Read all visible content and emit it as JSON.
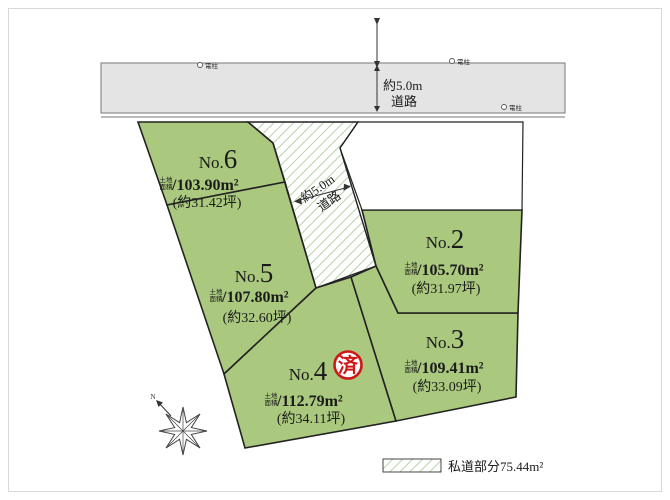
{
  "colors": {
    "lot_fill": "#aac87e",
    "lot_stroke": "#222222",
    "road_fill": "#e4e4e4",
    "hatch_line": "#a6c693",
    "stamp_red": "#cf1717",
    "text": "#1b1b1b"
  },
  "top_road": {
    "width_label": "約5.0m",
    "road_label": "道路"
  },
  "pole": {
    "label": "電柱"
  },
  "private_road": {
    "width_label": "約5.0m",
    "road_label": "道路"
  },
  "labels": {
    "slash": "/",
    "area_prefix_top": "土地",
    "area_prefix_bottom": "面積"
  },
  "lots": [
    {
      "id": "no6",
      "prefix": "No.",
      "number": "6",
      "area": "103.90m²",
      "tsubo": "(約31.42坪)"
    },
    {
      "id": "no5",
      "prefix": "No.",
      "number": "5",
      "area": "107.80m²",
      "tsubo": "(約32.60坪)"
    },
    {
      "id": "no2",
      "prefix": "No.",
      "number": "2",
      "area": "105.70m²",
      "tsubo": "(約31.97坪)"
    },
    {
      "id": "no3",
      "prefix": "No.",
      "number": "3",
      "area": "109.41m²",
      "tsubo": "(約33.09坪)"
    },
    {
      "id": "no4",
      "prefix": "No.",
      "number": "4",
      "area": "112.79m²",
      "tsubo": "(約34.11坪)"
    }
  ],
  "stamp": {
    "label": "済"
  },
  "compass": {
    "label": "N"
  },
  "legend": {
    "label": "私道部分75.44m²"
  }
}
